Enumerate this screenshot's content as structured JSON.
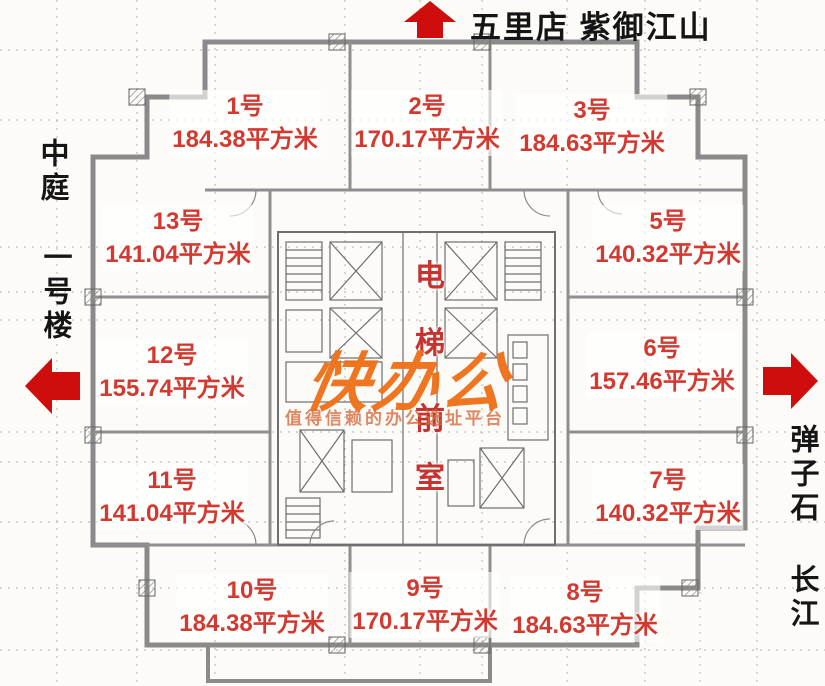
{
  "landmarks": {
    "top": "五里店 紫御江山",
    "left_top": "中庭",
    "left_mid": "一号楼",
    "right_top": "弹子石",
    "right_bottom": "长江"
  },
  "core_label": {
    "chars": [
      "电",
      "梯",
      "前",
      "室"
    ]
  },
  "watermark": {
    "logo": "快办公",
    "tagline": "值得信赖的办公选址平台"
  },
  "units": [
    {
      "name": "1号",
      "area": "184.38平方米"
    },
    {
      "name": "2号",
      "area": "170.17平方米"
    },
    {
      "name": "3号",
      "area": "184.63平方米"
    },
    {
      "name": "5号",
      "area": "140.32平方米"
    },
    {
      "name": "6号",
      "area": "157.46平方米"
    },
    {
      "name": "7号",
      "area": "140.32平方米"
    },
    {
      "name": "8号",
      "area": "184.63平方米"
    },
    {
      "name": "9号",
      "area": "170.17平方米"
    },
    {
      "name": "10号",
      "area": "184.38平方米"
    },
    {
      "name": "11号",
      "area": "141.04平方米"
    },
    {
      "name": "12号",
      "area": "155.74平方米"
    },
    {
      "name": "13号",
      "area": "141.04平方米"
    }
  ],
  "colors": {
    "unit_label": "#d23a31",
    "arrow": "#cf0d0d",
    "watermark": "#ef7019",
    "wall": "#8a8a8a",
    "landmark_text": "#151515"
  }
}
